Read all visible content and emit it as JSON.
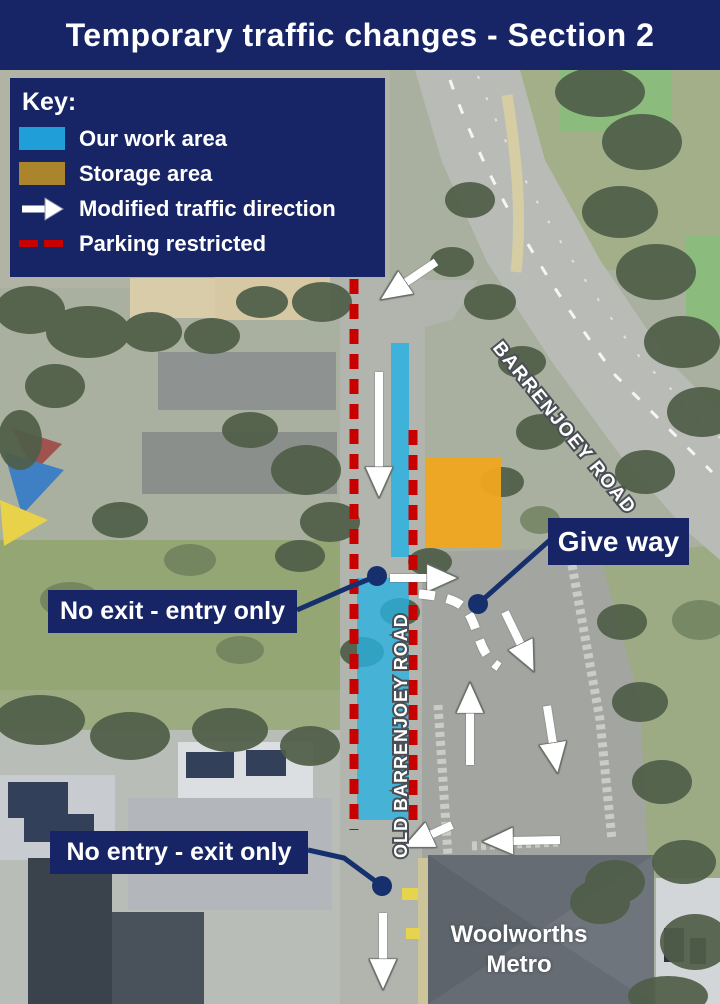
{
  "title": "Temporary traffic changes - Section 2",
  "key": {
    "heading": "Key:",
    "items": [
      {
        "id": "work-area",
        "label": "Our work area"
      },
      {
        "id": "storage-area",
        "label": "Storage area"
      },
      {
        "id": "traffic-direction",
        "label": "Modified traffic direction"
      },
      {
        "id": "parking-restricted",
        "label": "Parking restricted"
      }
    ]
  },
  "callouts": {
    "give_way": "Give way",
    "no_exit": "No exit - entry only",
    "no_entry": "No entry - exit only"
  },
  "roads": {
    "barrenjoey": "BARRENJOEY ROAD",
    "old_barrenjoey": "OLD BARRENJOEY ROAD"
  },
  "places": {
    "woolworths_line1": "Woolworths",
    "woolworths_line2": "Metro"
  },
  "colors": {
    "navy": "#172566",
    "work_area_blue": "#29b1e0",
    "storage_orange": "#f0a61e",
    "key_storage_gold": "#ab852c",
    "restricted_red": "#c80000",
    "arrow_white": "#ffffff"
  }
}
